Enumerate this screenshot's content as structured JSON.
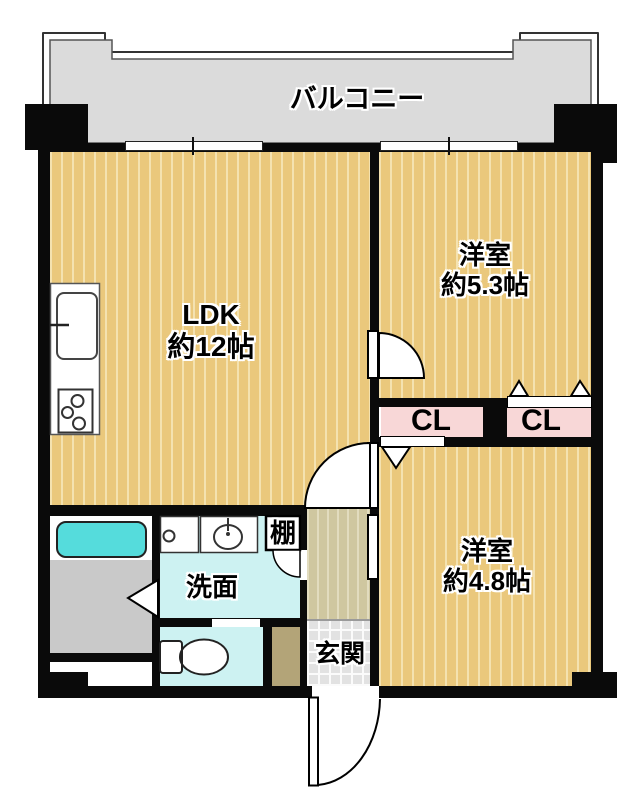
{
  "balcony": {
    "label": "バルコニー"
  },
  "rooms": {
    "ldk": {
      "name": "LDK",
      "size": "約12帖"
    },
    "western_room_1": {
      "name": "洋室",
      "size": "約5.3帖"
    },
    "western_room_2": {
      "name": "洋室",
      "size": "約4.8帖"
    }
  },
  "closets": {
    "left_label": "CL",
    "right_label": "CL"
  },
  "washroom": {
    "label": "洗面"
  },
  "entrance": {
    "label": "玄関"
  },
  "shelf": {
    "label": "棚"
  },
  "fixtures": {
    "kitchen": "kitchen-sink-and-stove",
    "bath": "bathtub",
    "laundry": "washing-machine-pan",
    "basin": "washbasin",
    "toilet": "toilet",
    "doors": [
      "hinged-door-swing",
      "sliding-door",
      "folding-closet-door",
      "entrance-door"
    ],
    "windows": [
      "balcony-sliding-window",
      "balcony-sliding-window"
    ]
  },
  "colors": {
    "wood_floor": "#eac87c",
    "wood_stripe": "#f4e2b0",
    "hallway_floor": "#cfc7a0",
    "entrance_tile": "#e2e2e2",
    "closet_pink": "#f8d7d7",
    "wet_area_cyan": "#cdf2f2",
    "bathtub_cyan": "#55dcdc",
    "bath_floor_gray": "#c9c9c9",
    "balcony_gray": "#dbdbdb",
    "hall_strip_olive": "#b3a478",
    "wall_black": "#0a0a0a"
  }
}
